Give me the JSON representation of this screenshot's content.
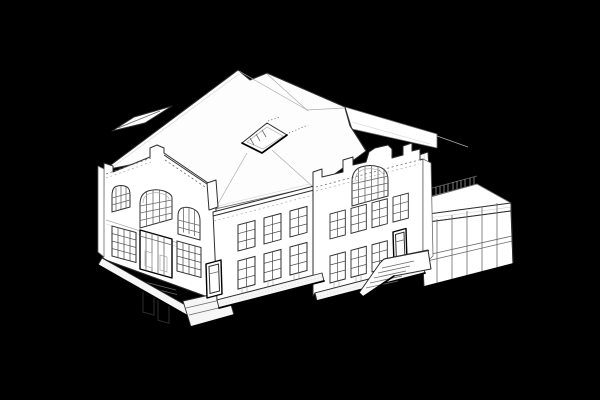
{
  "figure": {
    "type": "axonometric-architectural-line-drawing",
    "subject": "historic hall building with canted entrance front, crenellated parapets, large hipped roof with skylight, side wing, exterior stair and flat-roofed glazed annex",
    "style": "white line-art building on solid black background",
    "text_visible": "none"
  },
  "colors": {
    "bg": "#000000",
    "fill": "#ffffff",
    "fill-roof": "#fdfdfd",
    "fill-plinth": "#f6f6f6",
    "line-heavy": "#000000",
    "line-main": "#2e2e2e",
    "line-med": "#6a6a6a",
    "line-light": "#ababab",
    "line-faint": "#d2d2d2"
  },
  "inventory": {
    "arched_windows_front": 3,
    "arched_window_gable": 1,
    "gridded_windows_wing": 6,
    "gridded_windows_gable": 7,
    "entrance_double_door": 1,
    "side_doors": 2,
    "skylight_openings": 1,
    "exterior_stairs": 2,
    "annex_glazing_bays": 6,
    "roof_terrace_railing": 1,
    "chimney_slab": 1
  }
}
